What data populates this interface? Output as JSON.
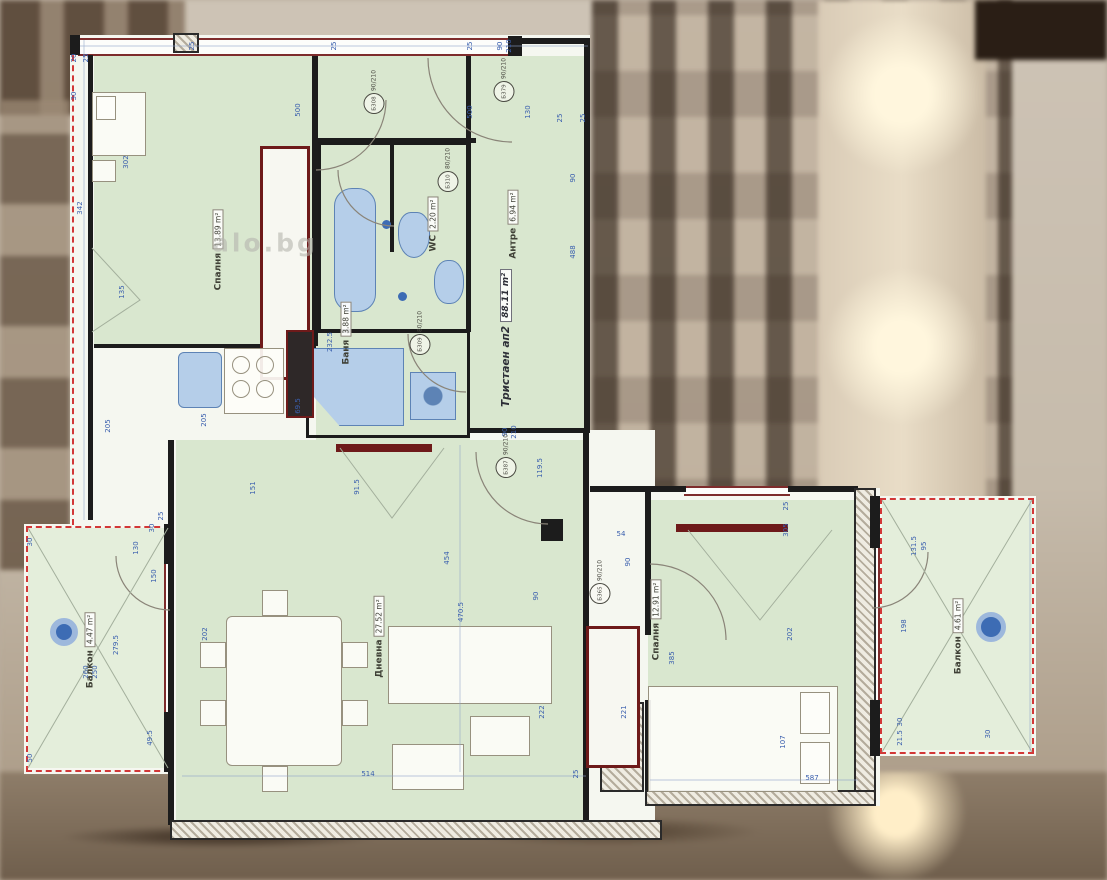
{
  "watermark": "alo.bg",
  "apartment": {
    "label": "Тристаен ап2",
    "area": "88.11 m²"
  },
  "rooms": [
    {
      "name": "Спалня",
      "area": "13.89 m²",
      "x": 218,
      "y": 250
    },
    {
      "name": "Баня",
      "area": "3.88 m²",
      "x": 346,
      "y": 333
    },
    {
      "name": "WC",
      "area": "2.20 m²",
      "x": 433,
      "y": 224
    },
    {
      "name": "Антре",
      "area": "6.94 m²",
      "x": 513,
      "y": 224
    },
    {
      "name": "Дневна",
      "area": "27.52 m²",
      "x": 379,
      "y": 637
    },
    {
      "name": "Спалня",
      "area": "12.91 m²",
      "x": 656,
      "y": 620
    },
    {
      "name": "Балкон",
      "area": "4.47 m²",
      "x": 90,
      "y": 650
    },
    {
      "name": "Балкон",
      "area": "4.61 m²",
      "x": 958,
      "y": 636
    }
  ],
  "door_tags": [
    {
      "code": "Б379",
      "size": "90/210",
      "x": 504,
      "y": 80
    },
    {
      "code": "Б308",
      "size": "90/210",
      "x": 374,
      "y": 92
    },
    {
      "code": "Б310",
      "size": "80/210",
      "x": 448,
      "y": 170
    },
    {
      "code": "Б309",
      "size": "80/210",
      "x": 420,
      "y": 333
    },
    {
      "code": "Б387",
      "size": "90/210",
      "x": 506,
      "y": 456
    },
    {
      "code": "Б365",
      "size": "90/210",
      "x": 600,
      "y": 582
    }
  ],
  "dimensions": [
    {
      "t": "25",
      "x": 192,
      "y": 46,
      "r": 1
    },
    {
      "t": "25",
      "x": 334,
      "y": 46,
      "r": 1
    },
    {
      "t": "25",
      "x": 470,
      "y": 46,
      "r": 1
    },
    {
      "t": "90",
      "x": 500,
      "y": 46,
      "r": 1
    },
    {
      "t": "210",
      "x": 509,
      "y": 46,
      "r": 1
    },
    {
      "t": "25",
      "x": 560,
      "y": 118,
      "r": 1
    },
    {
      "t": "25",
      "x": 583,
      "y": 118,
      "r": 1
    },
    {
      "t": "500",
      "x": 298,
      "y": 110,
      "r": 1
    },
    {
      "t": "500",
      "x": 470,
      "y": 112,
      "r": 1
    },
    {
      "t": "130",
      "x": 528,
      "y": 112,
      "r": 1
    },
    {
      "t": "20",
      "x": 74,
      "y": 58,
      "r": 1
    },
    {
      "t": "25",
      "x": 86,
      "y": 58,
      "r": 1
    },
    {
      "t": "30",
      "x": 74,
      "y": 96,
      "r": 1
    },
    {
      "t": "302",
      "x": 126,
      "y": 162,
      "r": 1
    },
    {
      "t": "342",
      "x": 80,
      "y": 208,
      "r": 1
    },
    {
      "t": "135",
      "x": 122,
      "y": 292,
      "r": 1
    },
    {
      "t": "205",
      "x": 108,
      "y": 426,
      "r": 1
    },
    {
      "t": "205",
      "x": 204,
      "y": 420,
      "r": 1
    },
    {
      "t": "232.5",
      "x": 330,
      "y": 342,
      "r": 1
    },
    {
      "t": "69.5",
      "x": 298,
      "y": 406,
      "r": 1
    },
    {
      "t": "90",
      "x": 573,
      "y": 178,
      "r": 1
    },
    {
      "t": "488",
      "x": 573,
      "y": 252,
      "r": 1
    },
    {
      "t": "151",
      "x": 253,
      "y": 488,
      "r": 1
    },
    {
      "t": "91.5",
      "x": 357,
      "y": 487,
      "r": 1
    },
    {
      "t": "90",
      "x": 505,
      "y": 432,
      "r": 1
    },
    {
      "t": "210",
      "x": 514,
      "y": 432,
      "r": 1
    },
    {
      "t": "119.5",
      "x": 540,
      "y": 468,
      "r": 1
    },
    {
      "t": "454",
      "x": 447,
      "y": 558,
      "r": 1
    },
    {
      "t": "470.5",
      "x": 461,
      "y": 612,
      "r": 1
    },
    {
      "t": "90",
      "x": 536,
      "y": 596,
      "r": 1
    },
    {
      "t": "30",
      "x": 152,
      "y": 528,
      "r": 1
    },
    {
      "t": "25",
      "x": 161,
      "y": 516,
      "r": 1
    },
    {
      "t": "130",
      "x": 136,
      "y": 548,
      "r": 1
    },
    {
      "t": "150",
      "x": 154,
      "y": 576,
      "r": 1
    },
    {
      "t": "202",
      "x": 205,
      "y": 634,
      "r": 1
    },
    {
      "t": "514",
      "x": 368,
      "y": 774,
      "r": 0
    },
    {
      "t": "222",
      "x": 542,
      "y": 712,
      "r": 1
    },
    {
      "t": "221",
      "x": 624,
      "y": 712,
      "r": 1
    },
    {
      "t": "25",
      "x": 576,
      "y": 774,
      "r": 1
    },
    {
      "t": "279.5",
      "x": 116,
      "y": 645,
      "r": 1
    },
    {
      "t": "260",
      "x": 86,
      "y": 672,
      "r": 1
    },
    {
      "t": "250",
      "x": 95,
      "y": 672,
      "r": 1
    },
    {
      "t": "49.5",
      "x": 150,
      "y": 738,
      "r": 1
    },
    {
      "t": "50",
      "x": 30,
      "y": 758,
      "r": 1
    },
    {
      "t": "30",
      "x": 30,
      "y": 542,
      "r": 1
    },
    {
      "t": "54",
      "x": 621,
      "y": 534,
      "r": 0
    },
    {
      "t": "25",
      "x": 786,
      "y": 506,
      "r": 1
    },
    {
      "t": "305",
      "x": 786,
      "y": 530,
      "r": 1
    },
    {
      "t": "90",
      "x": 628,
      "y": 562,
      "r": 1
    },
    {
      "t": "385",
      "x": 672,
      "y": 658,
      "r": 1
    },
    {
      "t": "202",
      "x": 790,
      "y": 634,
      "r": 1
    },
    {
      "t": "107",
      "x": 783,
      "y": 742,
      "r": 1
    },
    {
      "t": "587",
      "x": 812,
      "y": 778,
      "r": 0
    },
    {
      "t": "131.5",
      "x": 914,
      "y": 546,
      "r": 1
    },
    {
      "t": "95",
      "x": 924,
      "y": 546,
      "r": 1
    },
    {
      "t": "198",
      "x": 904,
      "y": 626,
      "r": 1
    },
    {
      "t": "30",
      "x": 900,
      "y": 722,
      "r": 1
    },
    {
      "t": "21.5",
      "x": 900,
      "y": 738,
      "r": 1
    },
    {
      "t": "30",
      "x": 988,
      "y": 734,
      "r": 1
    }
  ],
  "colors": {
    "dimension_text": "#3a5fae",
    "fixture_blue": "#b5cee9",
    "wall_black": "#1c1c1c",
    "room_green": "#d9e7cf",
    "projection_red_dash": "#d23737",
    "joinery_dark_red": "#6e1a1a"
  }
}
